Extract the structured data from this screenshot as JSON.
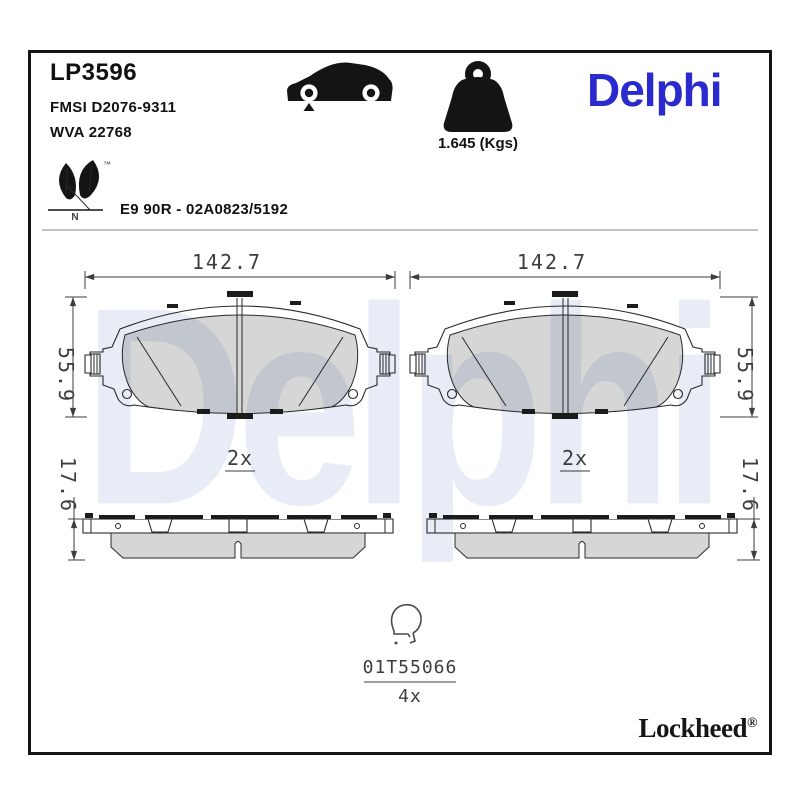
{
  "header": {
    "part_number": "LP3596",
    "fmsi": "FMSI D2076-9311",
    "wva": "WVA 22768",
    "weight": "1.645 (Kgs)",
    "brand_logo": "Delphi",
    "approval": "E9 90R - 02A0823/5192",
    "eco_n": "N",
    "eco_tm": "™"
  },
  "drawing": {
    "pad_width": "142.7",
    "pad_height": "55.9",
    "pad_thickness": "17.6",
    "pad_qty": "2x",
    "clip_part": "01T55066",
    "clip_qty": "4x"
  },
  "footer": {
    "brand": "Lockheed",
    "registered": "®"
  },
  "watermark_text": "Delphi",
  "colors": {
    "brand_blue": "#2A2ACF",
    "watermark_blue": "#E8ECF6",
    "friction_gray": "#D6D6D6",
    "line_dark": "#2A2A2A"
  }
}
